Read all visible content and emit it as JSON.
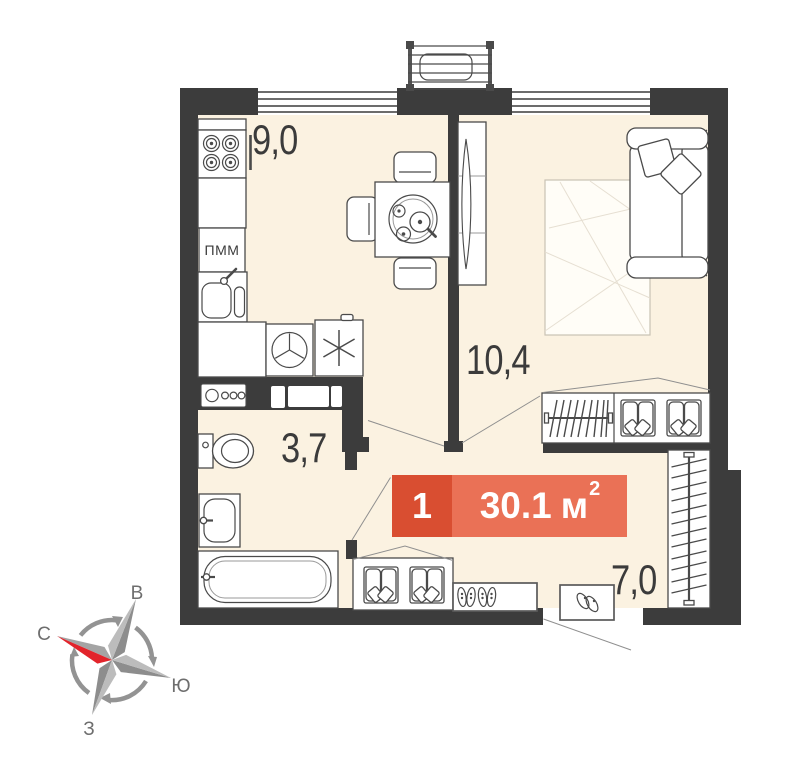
{
  "plan": {
    "badge": {
      "room_count": "1",
      "area_value": "30.1",
      "area_unit": "м",
      "area_superscript": "2",
      "color_dark": "#D94E31",
      "color_light": "#EA7156"
    },
    "rooms": [
      {
        "name": "kitchen",
        "area_label": "9,0"
      },
      {
        "name": "living-room",
        "area_label": "10,4"
      },
      {
        "name": "bathroom",
        "area_label": "3,7"
      },
      {
        "name": "hallway",
        "area_label": "7,0"
      }
    ],
    "appliance_labels": {
      "dishwasher": "ПММ"
    },
    "icons": [
      "stove-icon",
      "dishwasher-box",
      "kitchen-sink-icon",
      "washing-machine-icon",
      "fridge-snowflake-icon",
      "utility-panel-icon",
      "toilet-icon",
      "washbasin-icon",
      "bathtub-icon",
      "dining-table-icon",
      "chair-icon",
      "tea-tray-icon",
      "tv-stand-icon",
      "sofa-icon",
      "pillow-icon",
      "rug-icon",
      "wardrobe-hangers-icon",
      "shelf-unit-icon",
      "shoe-cabinet-icon",
      "shoes-icon",
      "door-mat-icon",
      "slippers-icon",
      "hanger-rail-icon",
      "window-icon",
      "ac-basket-icon",
      "compass-rose-icon"
    ],
    "colors": {
      "wall": "#3C3C3C",
      "floor": "#FBF2E1",
      "furniture_stroke": "#4a4a4a",
      "leader_line": "#8f8f8f",
      "north_arrow_red": "#E2242B"
    }
  },
  "compass": {
    "east_label": "В",
    "north_label": "С",
    "south_label": "Ю",
    "west_label": "З"
  }
}
